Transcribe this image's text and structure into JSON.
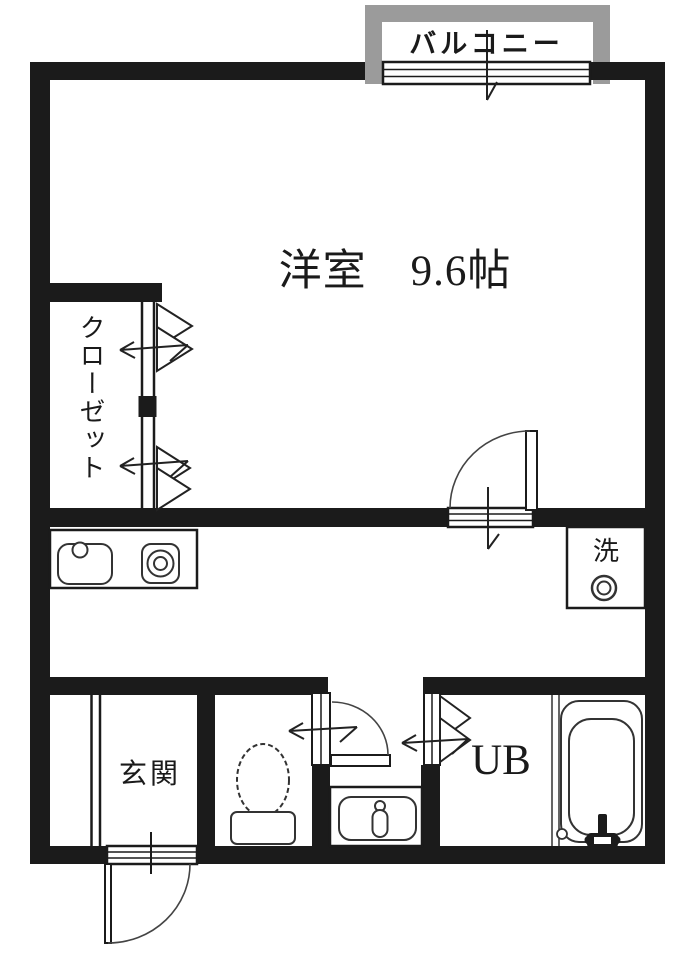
{
  "floorplan": {
    "balcony": {
      "label": "バルコニー"
    },
    "main_room": {
      "label": "洋室　9.6帖",
      "name": "洋室",
      "size": "9.6帖"
    },
    "closet": {
      "label": "クローゼット"
    },
    "kitchen": {
      "sink_icon": "sink-icon",
      "burner_icon": "stove-burner-icon"
    },
    "laundry": {
      "label": "洗",
      "icon": "water-tap-icon"
    },
    "entrance": {
      "label": "玄関"
    },
    "toilet": {
      "icon": "toilet-icon"
    },
    "washroom": {
      "icon": "washbasin-icon"
    },
    "unit_bath": {
      "label": "UB",
      "icon": "bathtub-icon"
    },
    "colors": {
      "wall": "#1b1b1b",
      "balcony_frame": "#9b9b9b",
      "background": "#ffffff",
      "line": "#333333"
    }
  }
}
